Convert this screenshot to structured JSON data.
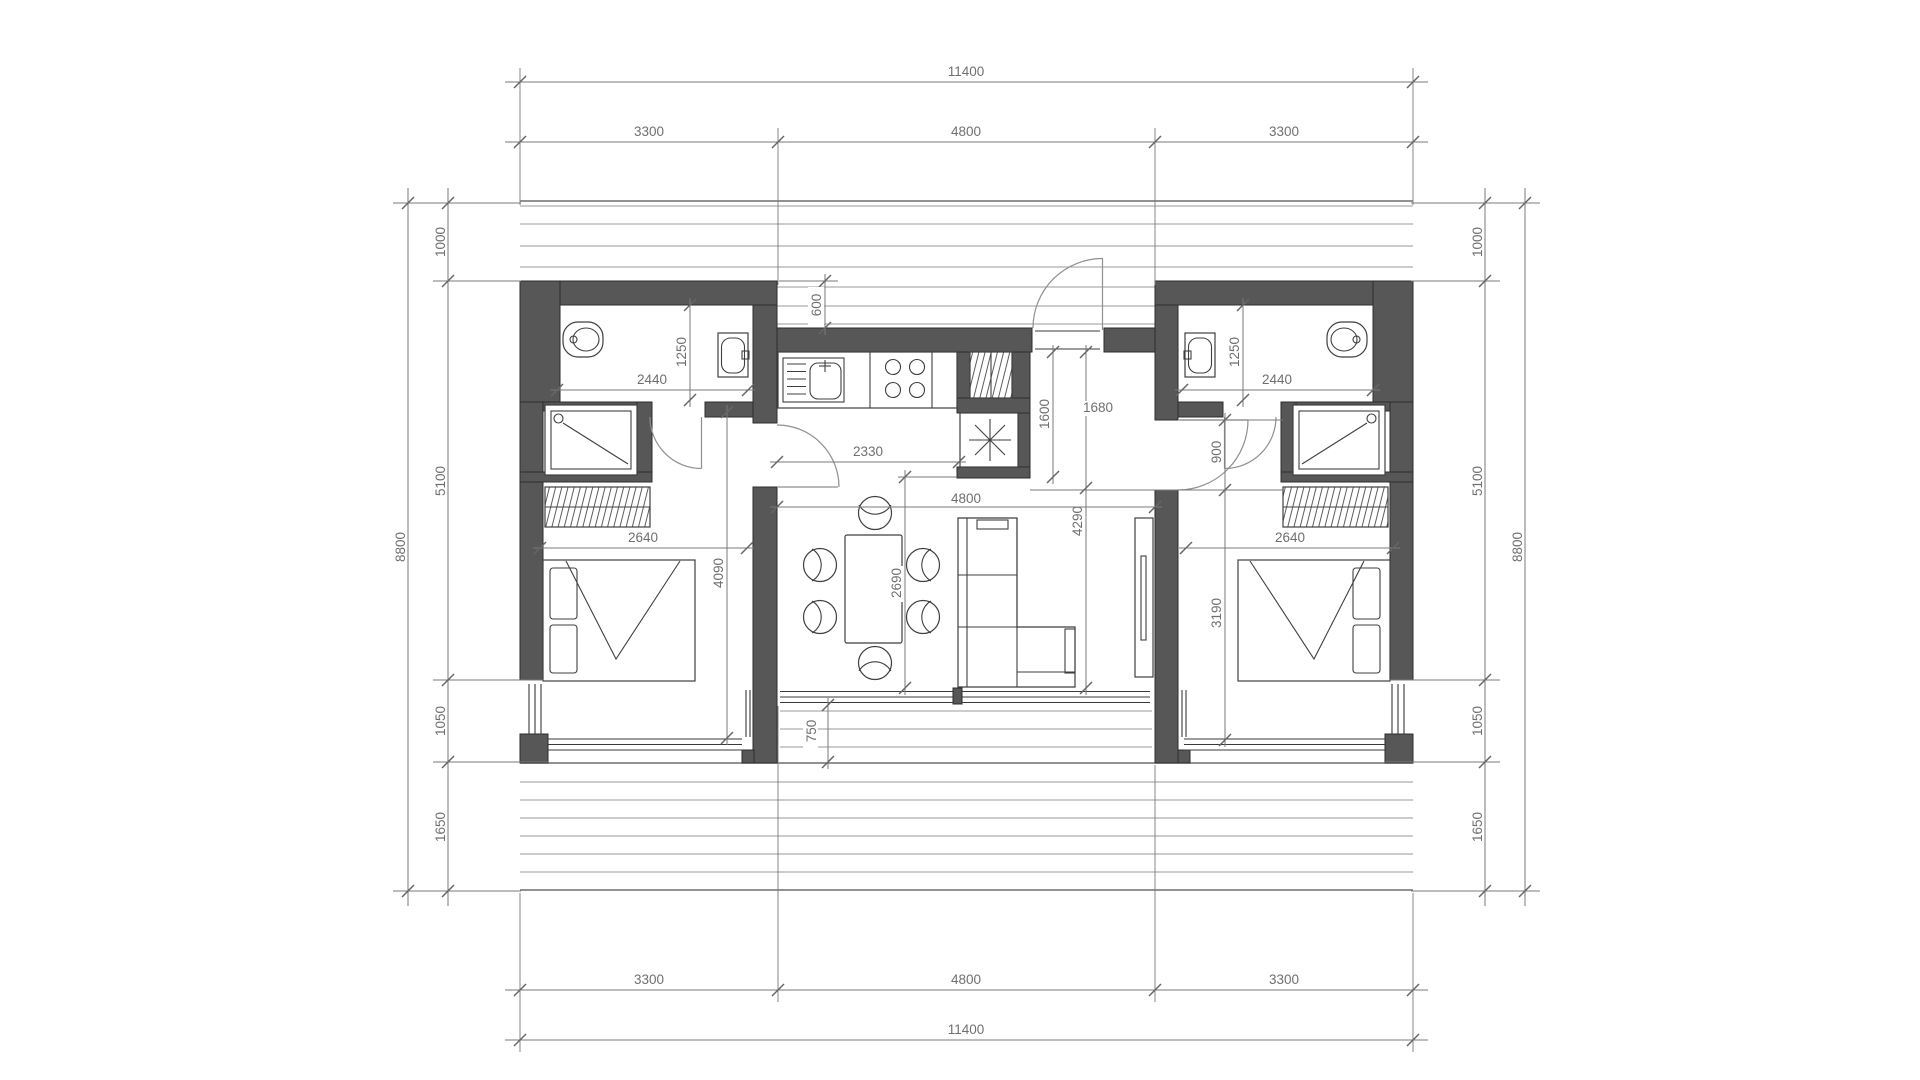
{
  "title": "two-unit house floor plan",
  "colors": {
    "wall": "#575757",
    "outline": "#2e2e2e",
    "furniture": "#3f3f3f",
    "dimension": "#7a7a7a",
    "dimension_text": "#6f6f6f",
    "deck_line": "#9a9a9a",
    "background": "#ffffff"
  },
  "dimensions": {
    "top": {
      "total": "11400",
      "left": "3300",
      "center": "4800",
      "right": "3300"
    },
    "bottom": {
      "total": "11400",
      "left": "3300",
      "center": "4800",
      "right": "3300"
    },
    "left_side": {
      "seg1": "1000",
      "seg2": "5100",
      "seg3": "1050",
      "seg4": "1650",
      "total": "8800"
    },
    "right_side": {
      "seg1": "1000",
      "seg2": "5100",
      "seg3": "1050",
      "seg4": "1650",
      "total": "8800"
    },
    "left_unit": {
      "bath_width": "2440",
      "bath_depth": "1250",
      "bed_width": "2640",
      "bed_depth": "4090"
    },
    "right_unit": {
      "bath_width": "2440",
      "bath_depth": "1250",
      "bed_width": "2640",
      "bed_depth": "3190",
      "door_width": "900"
    },
    "center_unit": {
      "north_offset": "600",
      "hall_width": "2330",
      "hall_depth": "1600",
      "entry_width": "1680",
      "living_width": "4800",
      "dining_depth": "2690",
      "living_depth": "4290",
      "porch_depth": "750"
    }
  }
}
